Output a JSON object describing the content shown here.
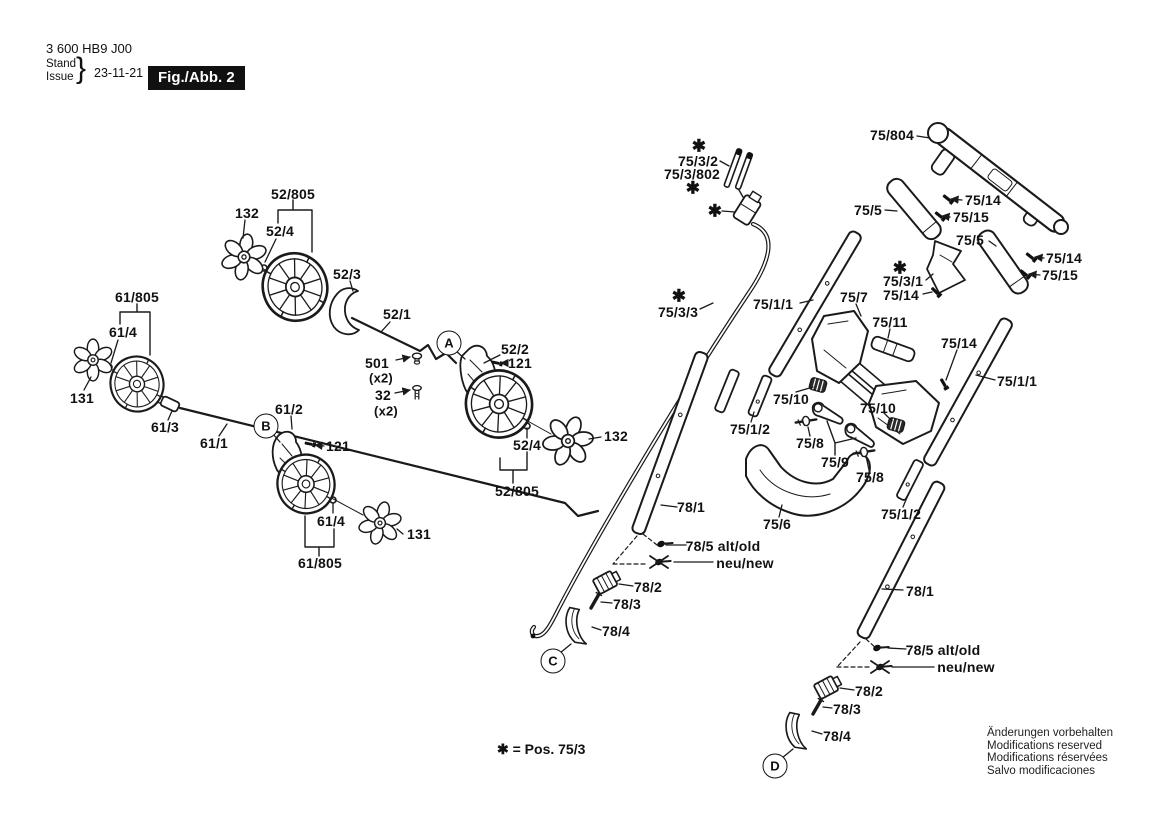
{
  "header": {
    "part_number": "3 600 HB9 J00",
    "stand": "Stand",
    "issue": "Issue",
    "brace": "}",
    "date": "23-11-21",
    "figure": "Fig./Abb. 2"
  },
  "legend": {
    "text": "✱ = Pos. 75/3"
  },
  "notices": [
    "Änderungen vorbehalten",
    "Modifications reserved",
    "Modifications réservées",
    "Salvo modificaciones"
  ],
  "colors": {
    "ink": "#1a1a1a",
    "paper": "#ffffff"
  },
  "callouts": [
    {
      "letter": "A",
      "x": 449,
      "y": 343
    },
    {
      "letter": "B",
      "x": 266,
      "y": 426
    },
    {
      "letter": "C",
      "x": 553,
      "y": 661
    },
    {
      "letter": "D",
      "x": 775,
      "y": 766
    }
  ],
  "part_labels": [
    {
      "t": "52/805",
      "x": 293,
      "y": 194
    },
    {
      "t": "132",
      "x": 247,
      "y": 213
    },
    {
      "t": "52/4",
      "x": 280,
      "y": 231
    },
    {
      "t": "52/3",
      "x": 347,
      "y": 274
    },
    {
      "t": "52/1",
      "x": 397,
      "y": 314
    },
    {
      "t": "501",
      "x": 377,
      "y": 363
    },
    {
      "t": "(x2)",
      "x": 381,
      "y": 378,
      "cls": "xtwo"
    },
    {
      "t": "32",
      "x": 383,
      "y": 395
    },
    {
      "t": "(x2)",
      "x": 386,
      "y": 411,
      "cls": "xtwo"
    },
    {
      "t": "52/2",
      "x": 515,
      "y": 349
    },
    {
      "t": "121",
      "x": 520,
      "y": 363
    },
    {
      "t": "52/4",
      "x": 527,
      "y": 445
    },
    {
      "t": "132",
      "x": 616,
      "y": 436
    },
    {
      "t": "52/805",
      "x": 517,
      "y": 491
    },
    {
      "t": "61/805",
      "x": 137,
      "y": 297
    },
    {
      "t": "61/4",
      "x": 123,
      "y": 332
    },
    {
      "t": "131",
      "x": 82,
      "y": 398
    },
    {
      "t": "61/3",
      "x": 165,
      "y": 427
    },
    {
      "t": "61/1",
      "x": 214,
      "y": 443
    },
    {
      "t": "61/2",
      "x": 289,
      "y": 409
    },
    {
      "t": "121",
      "x": 338,
      "y": 446
    },
    {
      "t": "61/4",
      "x": 331,
      "y": 521
    },
    {
      "t": "131",
      "x": 419,
      "y": 534
    },
    {
      "t": "61/805",
      "x": 320,
      "y": 563
    },
    {
      "t": "✱",
      "x": 699,
      "y": 146,
      "cls": "star"
    },
    {
      "t": "75/3/2",
      "x": 698,
      "y": 161
    },
    {
      "t": "75/3/802",
      "x": 692,
      "y": 174
    },
    {
      "t": "✱",
      "x": 693,
      "y": 188,
      "cls": "star"
    },
    {
      "t": "✱",
      "x": 715,
      "y": 211,
      "cls": "star"
    },
    {
      "t": "✱",
      "x": 679,
      "y": 296,
      "cls": "star"
    },
    {
      "t": "75/3/3",
      "x": 678,
      "y": 312
    },
    {
      "t": "75/804",
      "x": 892,
      "y": 135
    },
    {
      "t": "75/5",
      "x": 868,
      "y": 210
    },
    {
      "t": "75/14",
      "x": 983,
      "y": 200
    },
    {
      "t": "75/15",
      "x": 971,
      "y": 217
    },
    {
      "t": "75/5",
      "x": 970,
      "y": 240
    },
    {
      "t": "75/14",
      "x": 1064,
      "y": 258
    },
    {
      "t": "75/15",
      "x": 1060,
      "y": 275
    },
    {
      "t": "✱",
      "x": 900,
      "y": 268,
      "cls": "star"
    },
    {
      "t": "75/3/1",
      "x": 903,
      "y": 281
    },
    {
      "t": "75/14",
      "x": 901,
      "y": 295
    },
    {
      "t": "75/7",
      "x": 854,
      "y": 297
    },
    {
      "t": "75/1/1",
      "x": 773,
      "y": 304
    },
    {
      "t": "75/11",
      "x": 890,
      "y": 322
    },
    {
      "t": "75/14",
      "x": 959,
      "y": 343
    },
    {
      "t": "75/1/1",
      "x": 1017,
      "y": 381
    },
    {
      "t": "75/10",
      "x": 791,
      "y": 399
    },
    {
      "t": "75/10",
      "x": 878,
      "y": 408
    },
    {
      "t": "75/1/2",
      "x": 750,
      "y": 429
    },
    {
      "t": "75/8",
      "x": 810,
      "y": 443
    },
    {
      "t": "75/9",
      "x": 835,
      "y": 462
    },
    {
      "t": "75/8",
      "x": 870,
      "y": 477
    },
    {
      "t": "75/6",
      "x": 777,
      "y": 524
    },
    {
      "t": "75/1/2",
      "x": 901,
      "y": 514
    },
    {
      "t": "78/1",
      "x": 691,
      "y": 507
    },
    {
      "t": "78/5 alt/old",
      "x": 723,
      "y": 546
    },
    {
      "t": "neu/new",
      "x": 745,
      "y": 563
    },
    {
      "t": "78/2",
      "x": 648,
      "y": 587
    },
    {
      "t": "78/3",
      "x": 627,
      "y": 604
    },
    {
      "t": "78/4",
      "x": 616,
      "y": 631
    },
    {
      "t": "78/1",
      "x": 920,
      "y": 591
    },
    {
      "t": "78/5 alt/old",
      "x": 943,
      "y": 650
    },
    {
      "t": "neu/new",
      "x": 966,
      "y": 667
    },
    {
      "t": "78/2",
      "x": 869,
      "y": 691
    },
    {
      "t": "78/3",
      "x": 847,
      "y": 709
    },
    {
      "t": "78/4",
      "x": 837,
      "y": 736
    }
  ]
}
